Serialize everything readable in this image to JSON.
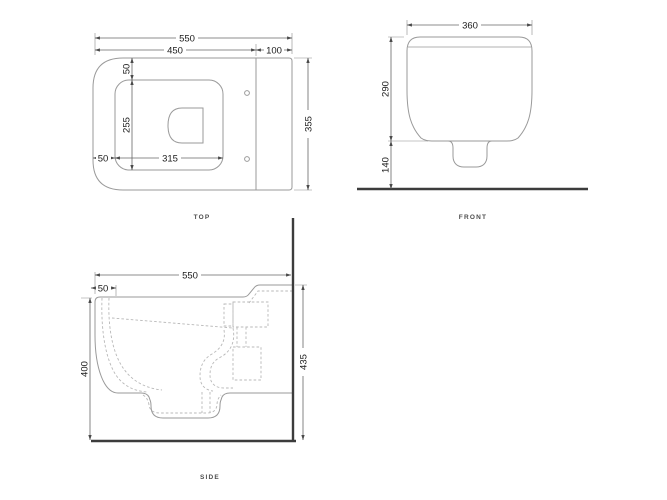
{
  "colors": {
    "line": "#9a9a9a",
    "dim": "#666666",
    "ext": "#8a8a8a",
    "dashed": "#b8b8b8",
    "heavy": "#3c3c3c",
    "text": "#1b1b1b",
    "label": "#4c4c4c",
    "background": "#ffffff"
  },
  "views": {
    "top": {
      "label": "TOP",
      "dims": {
        "overall_width": "550",
        "body_front_width": "450",
        "rear_section": "100",
        "overall_depth": "355",
        "rim_top_offset": "50",
        "opening_depth": "255",
        "opening_width": "315",
        "rim_left_offset": "50"
      }
    },
    "front": {
      "label": "FRONT",
      "dims": {
        "width": "360",
        "body_height": "290",
        "bottom_clearance": "140"
      }
    },
    "side": {
      "label": "SIDE",
      "dims": {
        "overall_depth": "550",
        "front_rim": "50",
        "front_height": "400",
        "wall_height": "435"
      }
    }
  }
}
